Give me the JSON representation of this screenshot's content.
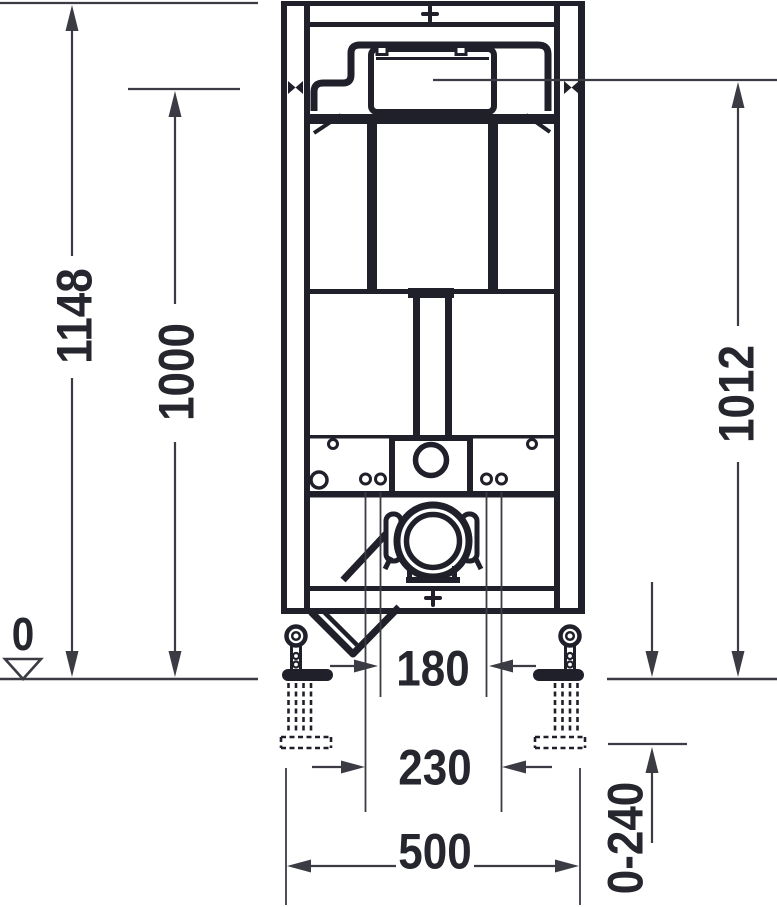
{
  "drawing": {
    "type": "technical-installation-drawing-front-view",
    "colors": {
      "structure_line": "#20202a",
      "dimension_line": "#3b3b44",
      "text": "#26262e",
      "background": "#ffffff"
    },
    "dimensions": {
      "overall_height": "1148",
      "height_1000": "1000",
      "height_1012": "1012",
      "floor_level": "0",
      "inner_fixing_spacing": "180",
      "outer_fixing_spacing": "230",
      "frame_width": "500",
      "foot_adjustment": "0-240"
    },
    "icons": {
      "center_mark": "+",
      "fixing_mark": "bowtie",
      "level_mark": "open-triangle"
    }
  }
}
